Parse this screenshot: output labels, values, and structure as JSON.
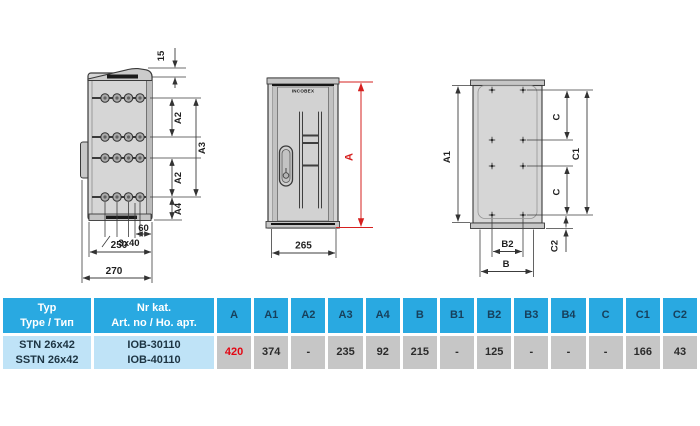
{
  "drawings": {
    "side_view": {
      "dim_15": "15",
      "dim_a2": "A2",
      "dim_a3": "A3",
      "dim_a4": "A4",
      "dim_spacing": "3x40",
      "dim_60": "60",
      "dim_250": "250",
      "dim_270": "270"
    },
    "front_view": {
      "brand": "INCOBEX",
      "dim_a": "A",
      "dim_265": "265"
    },
    "rear_view": {
      "dim_a1": "A1",
      "dim_c": "C",
      "dim_c1": "C1",
      "dim_c2": "C2",
      "dim_b": "B",
      "dim_b2": "B2"
    }
  },
  "colors": {
    "accent_red": "#d6201f",
    "value_red": "#e30613",
    "table_header_bg": "#29a9e1",
    "table_row_bg": "#bfe3f7",
    "table_value_bg": "#c6c6c6"
  },
  "table": {
    "header": {
      "type_col": [
        "Typ",
        "Type / Тип"
      ],
      "art_col": [
        "Nr kat.",
        "Art. no / Но. арт."
      ],
      "dims": [
        "A",
        "A1",
        "A2",
        "A3",
        "A4",
        "B",
        "B1",
        "B2",
        "B3",
        "B4",
        "C",
        "C1",
        "C2"
      ]
    },
    "row": {
      "types": [
        "STN 26x42",
        "SSTN 26x42"
      ],
      "art_nos": [
        "IOB-30110",
        "IOB-40110"
      ],
      "values": [
        "420",
        "374",
        "-",
        "235",
        "92",
        "215",
        "-",
        "125",
        "-",
        "-",
        "-",
        "166",
        "43"
      ]
    }
  }
}
